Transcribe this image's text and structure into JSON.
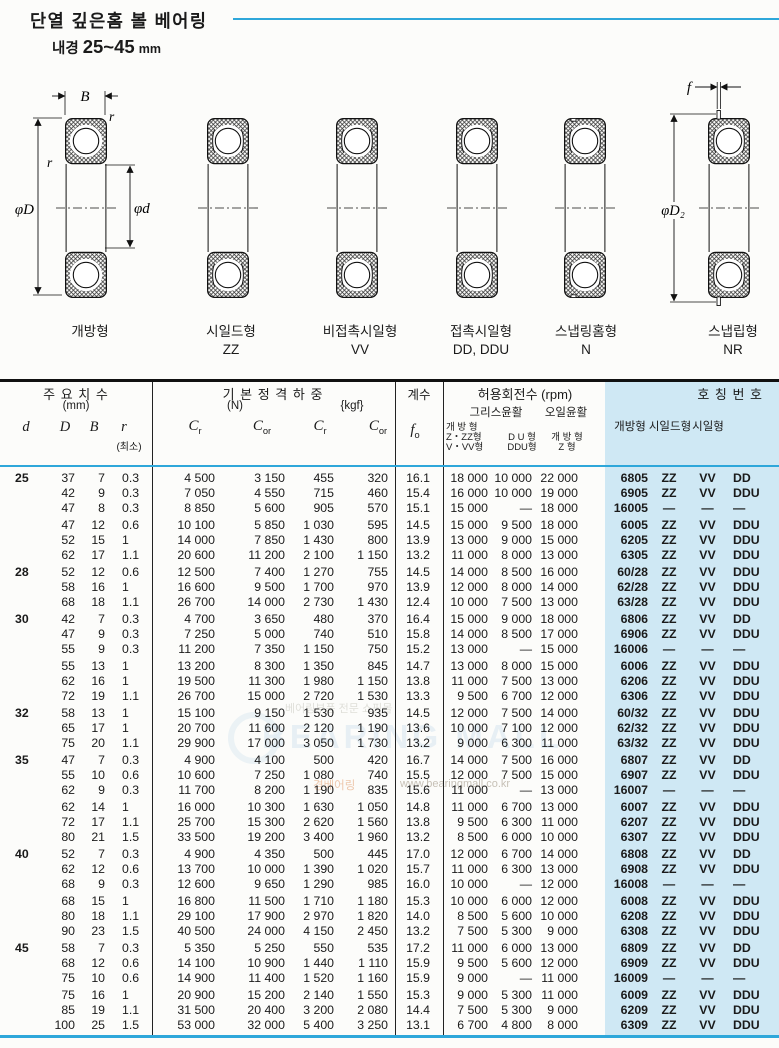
{
  "header": {
    "title": "단열 깊은홈 볼 베어링",
    "subtitle_label": "내경",
    "subtitle_range": "25~45",
    "subtitle_unit": "mm"
  },
  "diagrams": {
    "annotations": {
      "B": "B",
      "r_top": "r",
      "r_left": "r",
      "phiD": "φD",
      "phid": "φd",
      "f": "f",
      "phiD2": "φD₂"
    },
    "labels": [
      {
        "name": "개방형",
        "code": ""
      },
      {
        "name": "시일드형",
        "code": "ZZ"
      },
      {
        "name": "비접촉시일형",
        "code": "VV"
      },
      {
        "name": "접촉시일형",
        "code": "DD, DDU"
      },
      {
        "name": "스냅링홈형",
        "code": "N"
      },
      {
        "name": "스냅립형",
        "code": "NR"
      }
    ]
  },
  "table": {
    "header": {
      "dims_title": "주 요 치 수",
      "dims_unit": "(mm)",
      "col_d": "d",
      "col_D": "D",
      "col_B": "B",
      "col_r": "r",
      "col_r_min": "(최소)",
      "load_title": "기 본 정 격 하 중",
      "load_n": "(N)",
      "load_kgf": "{kgf}",
      "load_cols": [
        {
          "s": "C",
          "sub": "r"
        },
        {
          "s": "C",
          "sub": "or"
        },
        {
          "s": "C",
          "sub": "r"
        },
        {
          "s": "C",
          "sub": "or"
        }
      ],
      "factor_title": "계수",
      "factor_sym": "f",
      "factor_sub": "o",
      "speed_title": "허용회전수 (rpm)",
      "grease": "그리스윤활",
      "oil": "오일윤활",
      "grease_open_lines": [
        "개 방 형",
        "Z・ZZ형",
        "V・VV형"
      ],
      "grease_du_lines": [
        "D U 형",
        "DDU형"
      ],
      "oil_open_lines": [
        "개 방 형",
        "Z 형"
      ],
      "partno_title": "호 칭 번 호",
      "partno_cols": [
        "개방형",
        "시일드형",
        "시일형"
      ]
    },
    "clusters": [
      {
        "d": "25",
        "rows": [
          [
            "37",
            "7",
            "0.3",
            "4 500",
            "3 150",
            "455",
            "320",
            "16.1",
            "18 000",
            "10 000",
            "22 000",
            "6805",
            "ZZ",
            "VV",
            "DD"
          ],
          [
            "42",
            "9",
            "0.3",
            "7 050",
            "4 550",
            "715",
            "460",
            "15.4",
            "16 000",
            "10 000",
            "19 000",
            "6905",
            "ZZ",
            "VV",
            "DDU"
          ],
          [
            "47",
            "8",
            "0.3",
            "8 850",
            "5 600",
            "905",
            "570",
            "15.1",
            "15 000",
            "—",
            "18 000",
            "16005",
            "—",
            "—",
            "—"
          ]
        ]
      },
      {
        "d": "",
        "rows": [
          [
            "47",
            "12",
            "0.6",
            "10 100",
            "5 850",
            "1 030",
            "595",
            "14.5",
            "15 000",
            "9 500",
            "18 000",
            "6005",
            "ZZ",
            "VV",
            "DDU"
          ],
          [
            "52",
            "15",
            "1",
            "14 000",
            "7 850",
            "1 430",
            "800",
            "13.9",
            "13 000",
            "9 000",
            "15 000",
            "6205",
            "ZZ",
            "VV",
            "DDU"
          ],
          [
            "62",
            "17",
            "1.1",
            "20 600",
            "11 200",
            "2 100",
            "1 150",
            "13.2",
            "11 000",
            "8 000",
            "13 000",
            "6305",
            "ZZ",
            "VV",
            "DDU"
          ]
        ]
      },
      {
        "d": "28",
        "rows": [
          [
            "52",
            "12",
            "0.6",
            "12 500",
            "7 400",
            "1 270",
            "755",
            "14.5",
            "14 000",
            "8 500",
            "16 000",
            "60/28",
            "ZZ",
            "VV",
            "DDU"
          ],
          [
            "58",
            "16",
            "1",
            "16 600",
            "9 500",
            "1 700",
            "970",
            "13.9",
            "12 000",
            "8 000",
            "14 000",
            "62/28",
            "ZZ",
            "VV",
            "DDU"
          ],
          [
            "68",
            "18",
            "1.1",
            "26 700",
            "14 000",
            "2 730",
            "1 430",
            "12.4",
            "10 000",
            "7 500",
            "13 000",
            "63/28",
            "ZZ",
            "VV",
            "DDU"
          ]
        ]
      },
      {
        "d": "30",
        "rows": [
          [
            "42",
            "7",
            "0.3",
            "4 700",
            "3 650",
            "480",
            "370",
            "16.4",
            "15 000",
            "9 000",
            "18 000",
            "6806",
            "ZZ",
            "VV",
            "DD"
          ],
          [
            "47",
            "9",
            "0.3",
            "7 250",
            "5 000",
            "740",
            "510",
            "15.8",
            "14 000",
            "8 500",
            "17 000",
            "6906",
            "ZZ",
            "VV",
            "DDU"
          ],
          [
            "55",
            "9",
            "0.3",
            "11 200",
            "7 350",
            "1 150",
            "750",
            "15.2",
            "13 000",
            "—",
            "15 000",
            "16006",
            "—",
            "—",
            "—"
          ]
        ]
      },
      {
        "d": "",
        "rows": [
          [
            "55",
            "13",
            "1",
            "13 200",
            "8 300",
            "1 350",
            "845",
            "14.7",
            "13 000",
            "8 000",
            "15 000",
            "6006",
            "ZZ",
            "VV",
            "DDU"
          ],
          [
            "62",
            "16",
            "1",
            "19 500",
            "11 300",
            "1 980",
            "1 150",
            "13.8",
            "11 000",
            "7 500",
            "13 000",
            "6206",
            "ZZ",
            "VV",
            "DDU"
          ],
          [
            "72",
            "19",
            "1.1",
            "26 700",
            "15 000",
            "2 720",
            "1 530",
            "13.3",
            "9 500",
            "6 700",
            "12 000",
            "6306",
            "ZZ",
            "VV",
            "DDU"
          ]
        ]
      },
      {
        "d": "32",
        "rows": [
          [
            "58",
            "13",
            "1",
            "15 100",
            "9 150",
            "1 530",
            "935",
            "14.5",
            "12 000",
            "7 500",
            "14 000",
            "60/32",
            "ZZ",
            "VV",
            "DDU"
          ],
          [
            "65",
            "17",
            "1",
            "20 700",
            "11 600",
            "2 120",
            "1 190",
            "13.6",
            "10 000",
            "7 100",
            "12 000",
            "62/32",
            "ZZ",
            "VV",
            "DDU"
          ],
          [
            "75",
            "20",
            "1.1",
            "29 900",
            "17 000",
            "3 050",
            "1 730",
            "13.2",
            "9 000",
            "6 300",
            "11 000",
            "63/32",
            "ZZ",
            "VV",
            "DDU"
          ]
        ]
      },
      {
        "d": "35",
        "rows": [
          [
            "47",
            "7",
            "0.3",
            "4 900",
            "4 100",
            "500",
            "420",
            "16.7",
            "14 000",
            "7 500",
            "16 000",
            "6807",
            "ZZ",
            "VV",
            "DD"
          ],
          [
            "55",
            "10",
            "0.6",
            "10 600",
            "7 250",
            "1 080",
            "740",
            "15.5",
            "12 000",
            "7 500",
            "15 000",
            "6907",
            "ZZ",
            "VV",
            "DDU"
          ],
          [
            "62",
            "9",
            "0.3",
            "11 700",
            "8 200",
            "1 190",
            "835",
            "15.6",
            "11 000",
            "—",
            "13 000",
            "16007",
            "—",
            "—",
            "—"
          ]
        ]
      },
      {
        "d": "",
        "rows": [
          [
            "62",
            "14",
            "1",
            "16 000",
            "10 300",
            "1 630",
            "1 050",
            "14.8",
            "11 000",
            "6 700",
            "13 000",
            "6007",
            "ZZ",
            "VV",
            "DDU"
          ],
          [
            "72",
            "17",
            "1.1",
            "25 700",
            "15 300",
            "2 620",
            "1 560",
            "13.8",
            "9 500",
            "6 300",
            "11 000",
            "6207",
            "ZZ",
            "VV",
            "DDU"
          ],
          [
            "80",
            "21",
            "1.5",
            "33 500",
            "19 200",
            "3 400",
            "1 960",
            "13.2",
            "8 500",
            "6 000",
            "10 000",
            "6307",
            "ZZ",
            "VV",
            "DDU"
          ]
        ]
      },
      {
        "d": "40",
        "rows": [
          [
            "52",
            "7",
            "0.3",
            "4 900",
            "4 350",
            "500",
            "445",
            "17.0",
            "12 000",
            "6 700",
            "14 000",
            "6808",
            "ZZ",
            "VV",
            "DD"
          ],
          [
            "62",
            "12",
            "0.6",
            "13 700",
            "10 000",
            "1 390",
            "1 020",
            "15.7",
            "11 000",
            "6 300",
            "13 000",
            "6908",
            "ZZ",
            "VV",
            "DDU"
          ],
          [
            "68",
            "9",
            "0.3",
            "12 600",
            "9 650",
            "1 290",
            "985",
            "16.0",
            "10 000",
            "—",
            "12 000",
            "16008",
            "—",
            "—",
            "—"
          ]
        ]
      },
      {
        "d": "",
        "rows": [
          [
            "68",
            "15",
            "1",
            "16 800",
            "11 500",
            "1 710",
            "1 180",
            "15.3",
            "10 000",
            "6 000",
            "12 000",
            "6008",
            "ZZ",
            "VV",
            "DDU"
          ],
          [
            "80",
            "18",
            "1.1",
            "29 100",
            "17 900",
            "2 970",
            "1 820",
            "14.0",
            "8 500",
            "5 600",
            "10 000",
            "6208",
            "ZZ",
            "VV",
            "DDU"
          ],
          [
            "90",
            "23",
            "1.5",
            "40 500",
            "24 000",
            "4 150",
            "2 450",
            "13.2",
            "7 500",
            "5 300",
            "9 000",
            "6308",
            "ZZ",
            "VV",
            "DDU"
          ]
        ]
      },
      {
        "d": "45",
        "rows": [
          [
            "58",
            "7",
            "0.3",
            "5 350",
            "5 250",
            "550",
            "535",
            "17.2",
            "11 000",
            "6 000",
            "13 000",
            "6809",
            "ZZ",
            "VV",
            "DD"
          ],
          [
            "68",
            "12",
            "0.6",
            "14 100",
            "10 900",
            "1 440",
            "1 110",
            "15.9",
            "9 500",
            "5 600",
            "12 000",
            "6909",
            "ZZ",
            "VV",
            "DDU"
          ],
          [
            "75",
            "10",
            "0.6",
            "14 900",
            "11 400",
            "1 520",
            "1 160",
            "15.9",
            "9 000",
            "—",
            "11 000",
            "16009",
            "—",
            "—",
            "—"
          ]
        ]
      },
      {
        "d": "",
        "rows": [
          [
            "75",
            "16",
            "1",
            "20 900",
            "15 200",
            "2 140",
            "1 550",
            "15.3",
            "9 000",
            "5 300",
            "11 000",
            "6009",
            "ZZ",
            "VV",
            "DDU"
          ],
          [
            "85",
            "19",
            "1.1",
            "31 500",
            "20 400",
            "3 200",
            "2 080",
            "14.4",
            "7 500",
            "5 300",
            "9 000",
            "6209",
            "ZZ",
            "VV",
            "DDU"
          ],
          [
            "100",
            "25",
            "1.5",
            "53 000",
            "32 000",
            "5 400",
            "3 250",
            "13.1",
            "6 700",
            "4 800",
            "8 000",
            "6309",
            "ZZ",
            "VV",
            "DDU"
          ]
        ]
      }
    ]
  },
  "watermark": {
    "brand": "BEARING MALL",
    "tagline": "베어링부품 전문 쇼핑몰",
    "korean": "경베어링",
    "url": "www.bearingmall.co.kr"
  },
  "colors": {
    "accent_cyan": "#2ea7da",
    "partno_band": "#cfe8f4"
  }
}
